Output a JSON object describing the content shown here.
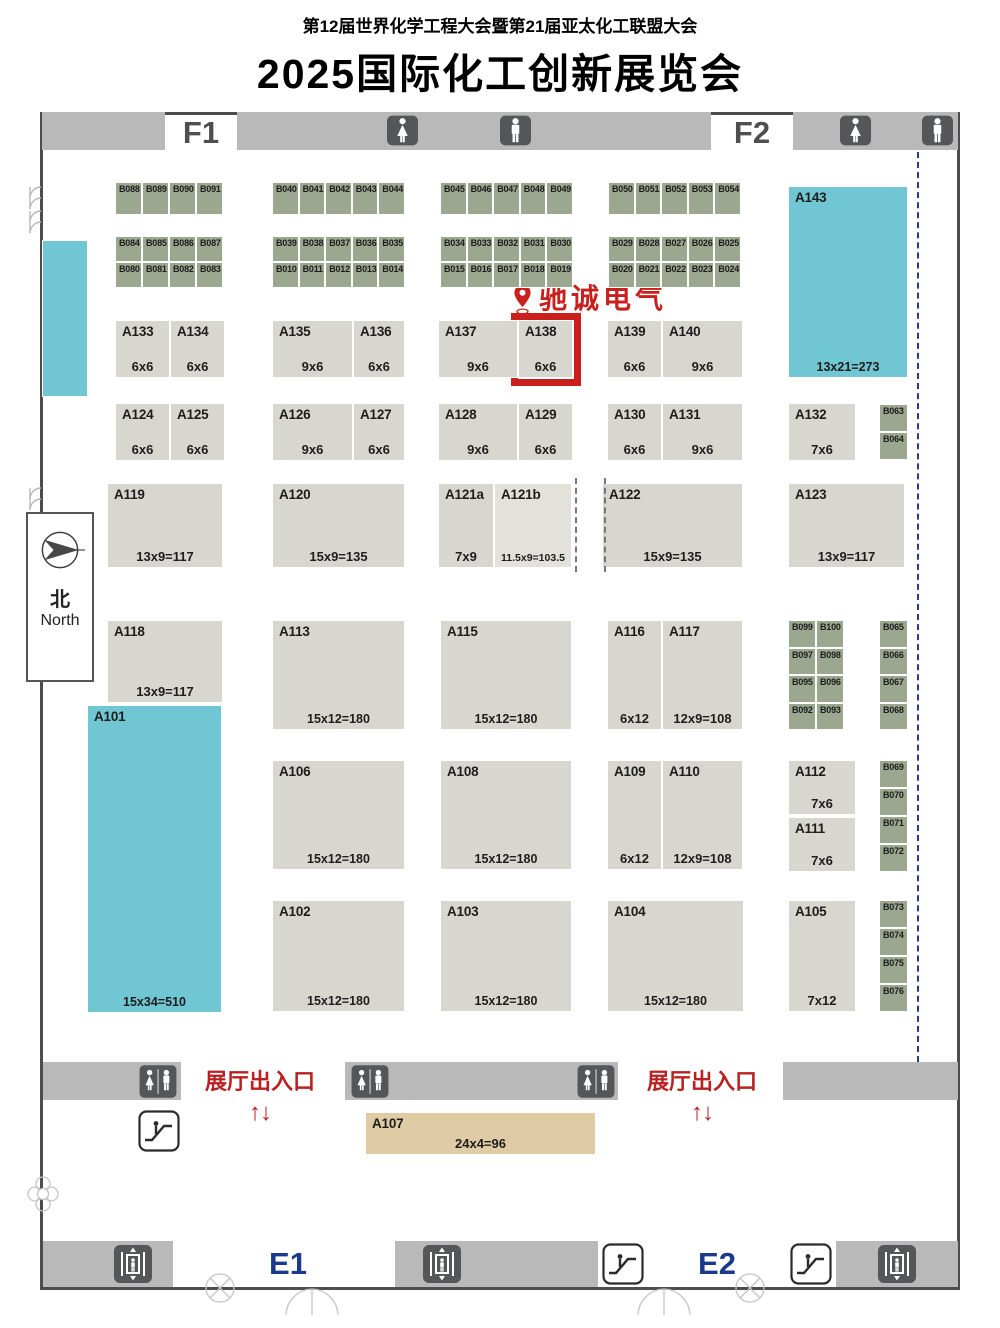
{
  "header": {
    "subtitle": "第12届世界化学工程大会暨第21届亚太化工联盟大会",
    "title": "2025国际化工创新展览会"
  },
  "marker": {
    "label": "驰诚电气",
    "booth": "A138",
    "pin_x": 511,
    "pin_y": 284,
    "color": "#c9201d"
  },
  "highlight_box": {
    "x": 511,
    "y": 313,
    "w": 70,
    "h": 73
  },
  "compass": {
    "zh": "北",
    "en": "North",
    "x": 26,
    "y": 512,
    "w": 68,
    "h": 170
  },
  "colors": {
    "booth_standard": "#d7d7cf",
    "booth_light": "#e2e2db",
    "booth_green": "#9ca78f",
    "booth_cyan": "#70c6d2",
    "booth_tan": "#dfcba4",
    "bar_gray": "#b9b9b9",
    "accent_red": "#c9201d",
    "navy": "#1b3a8c",
    "icon_dark": "#55565a"
  },
  "map": {
    "hall_labels": [
      {
        "text": "F1",
        "x": 165,
        "w": 72,
        "y": 116,
        "color": "#4f4f4f"
      },
      {
        "text": "F2",
        "x": 711,
        "w": 82,
        "y": 116,
        "color": "#4f4f4f"
      },
      {
        "text": "E1",
        "x": 252,
        "w": 72,
        "y": 1247,
        "color": "#1b3a8c"
      },
      {
        "text": "E2",
        "x": 681,
        "w": 72,
        "y": 1247,
        "color": "#1b3a8c"
      }
    ],
    "entrances": [
      {
        "label": "展厅出入口",
        "arrows": "↑↓",
        "x": 190,
        "y": 1064,
        "w": 140
      },
      {
        "label": "展厅出入口",
        "arrows": "↑↓",
        "x": 632,
        "y": 1064,
        "w": 140
      }
    ],
    "top_bars": [
      {
        "x": 42,
        "y": 112,
        "w": 123,
        "h": 38
      },
      {
        "x": 237,
        "y": 112,
        "w": 474,
        "h": 38
      },
      {
        "x": 793,
        "y": 112,
        "w": 165,
        "h": 38
      }
    ],
    "mid_bars": [
      {
        "x": 43,
        "y": 1062,
        "w": 138,
        "h": 38
      },
      {
        "x": 345,
        "y": 1062,
        "w": 273,
        "h": 38
      },
      {
        "x": 783,
        "y": 1062,
        "w": 175,
        "h": 38
      }
    ],
    "bottom_bars": [
      {
        "x": 43,
        "y": 1241,
        "w": 130,
        "h": 46
      },
      {
        "x": 395,
        "y": 1241,
        "w": 203,
        "h": 46
      },
      {
        "x": 836,
        "y": 1241,
        "w": 122,
        "h": 46
      }
    ],
    "shapes": [
      {
        "name": "cyan-strip",
        "kind": "cyan",
        "x": 42,
        "y": 240,
        "w": 46,
        "h": 157
      }
    ],
    "booths": [
      {
        "id": "A133",
        "size": "6x6",
        "x": 115,
        "y": 320,
        "w": 55,
        "h": 58
      },
      {
        "id": "A134",
        "size": "6x6",
        "x": 170,
        "y": 320,
        "w": 55,
        "h": 58
      },
      {
        "id": "A135",
        "size": "9x6",
        "x": 272,
        "y": 320,
        "w": 81,
        "h": 58
      },
      {
        "id": "A136",
        "size": "6x6",
        "x": 353,
        "y": 320,
        "w": 52,
        "h": 58
      },
      {
        "id": "A137",
        "size": "9x6",
        "x": 438,
        "y": 320,
        "w": 80,
        "h": 58
      },
      {
        "id": "A138",
        "size": "6x6",
        "x": 518,
        "y": 320,
        "w": 55,
        "h": 58
      },
      {
        "id": "A139",
        "size": "6x6",
        "x": 607,
        "y": 320,
        "w": 55,
        "h": 58
      },
      {
        "id": "A140",
        "size": "9x6",
        "x": 662,
        "y": 320,
        "w": 81,
        "h": 58
      },
      {
        "id": "A143",
        "size": "13x21=273",
        "kind": "cyan",
        "x": 788,
        "y": 186,
        "w": 120,
        "h": 192
      },
      {
        "id": "A124",
        "size": "6x6",
        "x": 115,
        "y": 403,
        "w": 55,
        "h": 58
      },
      {
        "id": "A125",
        "size": "6x6",
        "x": 170,
        "y": 403,
        "w": 55,
        "h": 58
      },
      {
        "id": "A126",
        "size": "9x6",
        "x": 272,
        "y": 403,
        "w": 81,
        "h": 58
      },
      {
        "id": "A127",
        "size": "6x6",
        "x": 353,
        "y": 403,
        "w": 52,
        "h": 58
      },
      {
        "id": "A128",
        "size": "9x6",
        "x": 438,
        "y": 403,
        "w": 80,
        "h": 58
      },
      {
        "id": "A129",
        "size": "6x6",
        "x": 518,
        "y": 403,
        "w": 55,
        "h": 58
      },
      {
        "id": "A130",
        "size": "6x6",
        "x": 607,
        "y": 403,
        "w": 55,
        "h": 58
      },
      {
        "id": "A131",
        "size": "9x6",
        "x": 662,
        "y": 403,
        "w": 81,
        "h": 58
      },
      {
        "id": "A132",
        "size": "7x6",
        "x": 788,
        "y": 403,
        "w": 68,
        "h": 58
      },
      {
        "id": "A119",
        "size": "13x9=117",
        "x": 107,
        "y": 483,
        "w": 116,
        "h": 85
      },
      {
        "id": "A120",
        "size": "15x9=135",
        "x": 272,
        "y": 483,
        "w": 133,
        "h": 85
      },
      {
        "id": "A121a",
        "size": "7x9",
        "x": 438,
        "y": 483,
        "w": 56,
        "h": 85
      },
      {
        "id": "A121b",
        "size": "11.5x9=103.5",
        "kind": "light",
        "x": 494,
        "y": 483,
        "w": 78,
        "h": 85
      },
      {
        "id": "A122",
        "size": "15x9=135",
        "x": 602,
        "y": 483,
        "w": 141,
        "h": 85
      },
      {
        "id": "A123",
        "size": "13x9=117",
        "x": 788,
        "y": 483,
        "w": 117,
        "h": 85
      },
      {
        "id": "A118",
        "size": "13x9=117",
        "x": 107,
        "y": 620,
        "w": 116,
        "h": 83
      },
      {
        "id": "A113",
        "size": "15x12=180",
        "x": 272,
        "y": 620,
        "w": 133,
        "h": 110
      },
      {
        "id": "A115",
        "size": "15x12=180",
        "x": 440,
        "y": 620,
        "w": 132,
        "h": 110
      },
      {
        "id": "A116",
        "size": "6x12",
        "x": 607,
        "y": 620,
        "w": 55,
        "h": 110
      },
      {
        "id": "A117",
        "size": "12x9=108",
        "x": 662,
        "y": 620,
        "w": 81,
        "h": 110
      },
      {
        "id": "A101",
        "size": "15x34=510",
        "kind": "cyan",
        "x": 87,
        "y": 705,
        "w": 135,
        "h": 308
      },
      {
        "id": "A106",
        "size": "15x12=180",
        "x": 272,
        "y": 760,
        "w": 133,
        "h": 110
      },
      {
        "id": "A108",
        "size": "15x12=180",
        "x": 440,
        "y": 760,
        "w": 132,
        "h": 110
      },
      {
        "id": "A109",
        "size": "6x12",
        "x": 607,
        "y": 760,
        "w": 55,
        "h": 110
      },
      {
        "id": "A110",
        "size": "12x9=108",
        "x": 662,
        "y": 760,
        "w": 81,
        "h": 110
      },
      {
        "id": "A112",
        "size": "7x6",
        "x": 788,
        "y": 760,
        "w": 68,
        "h": 55
      },
      {
        "id": "A111",
        "size": "7x6",
        "x": 788,
        "y": 817,
        "w": 68,
        "h": 55
      },
      {
        "id": "A102",
        "size": "15x12=180",
        "x": 272,
        "y": 900,
        "w": 133,
        "h": 112
      },
      {
        "id": "A103",
        "size": "15x12=180",
        "x": 440,
        "y": 900,
        "w": 132,
        "h": 112
      },
      {
        "id": "A104",
        "size": "15x12=180",
        "x": 607,
        "y": 900,
        "w": 137,
        "h": 112
      },
      {
        "id": "A105",
        "size": "7x12",
        "x": 788,
        "y": 900,
        "w": 68,
        "h": 112
      },
      {
        "id": "A107",
        "size": "24x4=96",
        "kind": "tan",
        "x": 365,
        "y": 1112,
        "w": 231,
        "h": 43
      }
    ],
    "b_groups": [
      {
        "x": 115,
        "y": 182,
        "cw": 27,
        "ch": 33,
        "rows": [
          [
            "B088",
            "B089",
            "B090",
            "B091"
          ]
        ]
      },
      {
        "x": 272,
        "y": 182,
        "cw": 26.6,
        "ch": 33,
        "rows": [
          [
            "B040",
            "B041",
            "B042",
            "B043",
            "B044"
          ]
        ]
      },
      {
        "x": 440,
        "y": 182,
        "cw": 26.6,
        "ch": 33,
        "rows": [
          [
            "B045",
            "B046",
            "B047",
            "B048",
            "B049"
          ]
        ]
      },
      {
        "x": 608,
        "y": 182,
        "cw": 26.6,
        "ch": 33,
        "rows": [
          [
            "B050",
            "B051",
            "B052",
            "B053",
            "B054"
          ]
        ]
      },
      {
        "x": 115,
        "y": 236,
        "cw": 27,
        "ch": 26,
        "rows": [
          [
            "B084",
            "B085",
            "B086",
            "B087"
          ],
          [
            "B080",
            "B081",
            "B082",
            "B083"
          ]
        ]
      },
      {
        "x": 272,
        "y": 236,
        "cw": 26.6,
        "ch": 26,
        "rows": [
          [
            "B039",
            "B038",
            "B037",
            "B036",
            "B035"
          ],
          [
            "B010",
            "B011",
            "B012",
            "B013",
            "B014"
          ]
        ]
      },
      {
        "x": 440,
        "y": 236,
        "cw": 26.6,
        "ch": 26,
        "rows": [
          [
            "B034",
            "B033",
            "B032",
            "B031",
            "B030"
          ],
          [
            "B015",
            "B016",
            "B017",
            "B018",
            "B019"
          ]
        ]
      },
      {
        "x": 608,
        "y": 236,
        "cw": 26.6,
        "ch": 26,
        "rows": [
          [
            "B029",
            "B028",
            "B027",
            "B026",
            "B025"
          ],
          [
            "B020",
            "B021",
            "B022",
            "B023",
            "B024"
          ]
        ]
      },
      {
        "x": 879,
        "y": 404,
        "cw": 29,
        "ch": 28,
        "rows": [
          [
            "B063"
          ],
          [
            "B064"
          ]
        ]
      },
      {
        "x": 788,
        "y": 620,
        "cw": 28,
        "ch": 27.5,
        "rows": [
          [
            "B099",
            "B100"
          ],
          [
            "B097",
            "B098"
          ],
          [
            "B095",
            "B096"
          ],
          [
            "B092",
            "B093"
          ]
        ]
      },
      {
        "x": 879,
        "y": 620,
        "cw": 29,
        "ch": 27.5,
        "rows": [
          [
            "B065"
          ],
          [
            "B066"
          ],
          [
            "B067"
          ],
          [
            "B068"
          ]
        ]
      },
      {
        "x": 879,
        "y": 760,
        "cw": 29,
        "ch": 28,
        "rows": [
          [
            "B069"
          ],
          [
            "B070"
          ],
          [
            "B071"
          ],
          [
            "B072"
          ]
        ]
      },
      {
        "x": 879,
        "y": 900,
        "cw": 29,
        "ch": 28,
        "rows": [
          [
            "B073"
          ],
          [
            "B074"
          ],
          [
            "B075"
          ],
          [
            "B076"
          ]
        ]
      }
    ],
    "toilets": [
      {
        "kind": "female",
        "x": 386,
        "y": 115
      },
      {
        "kind": "male",
        "x": 499,
        "y": 115
      },
      {
        "kind": "female",
        "x": 839,
        "y": 115
      },
      {
        "kind": "male",
        "x": 921,
        "y": 115
      },
      {
        "kind": "unisex",
        "x": 139,
        "y": 1064
      },
      {
        "kind": "unisex",
        "x": 351,
        "y": 1064
      },
      {
        "kind": "unisex",
        "x": 577,
        "y": 1064
      }
    ],
    "elevators": [
      {
        "x": 113,
        "y": 1244
      },
      {
        "x": 422,
        "y": 1244
      },
      {
        "x": 877,
        "y": 1244
      }
    ],
    "escalators": [
      {
        "x": 138,
        "y": 1110
      },
      {
        "x": 602,
        "y": 1243
      },
      {
        "x": 790,
        "y": 1243
      }
    ],
    "boundary_dash": {
      "x": 917,
      "y": 152,
      "h": 910
    },
    "split_dashes": [
      {
        "x": 575,
        "y": 478,
        "h": 94
      },
      {
        "x": 604,
        "y": 478,
        "h": 94
      }
    ],
    "decorations": [
      {
        "kind": "door-pair",
        "x": 26,
        "y": 186
      },
      {
        "kind": "door-pair",
        "x": 26,
        "y": 210
      },
      {
        "kind": "door-pair",
        "x": 26,
        "y": 487
      },
      {
        "kind": "flower",
        "x": 24,
        "y": 1172
      },
      {
        "kind": "circle-door",
        "x": 198,
        "y": 1268
      },
      {
        "kind": "swing-door",
        "x": 284,
        "y": 1286
      },
      {
        "kind": "swing-door",
        "x": 636,
        "y": 1286
      },
      {
        "kind": "circle-door",
        "x": 728,
        "y": 1268
      }
    ]
  }
}
